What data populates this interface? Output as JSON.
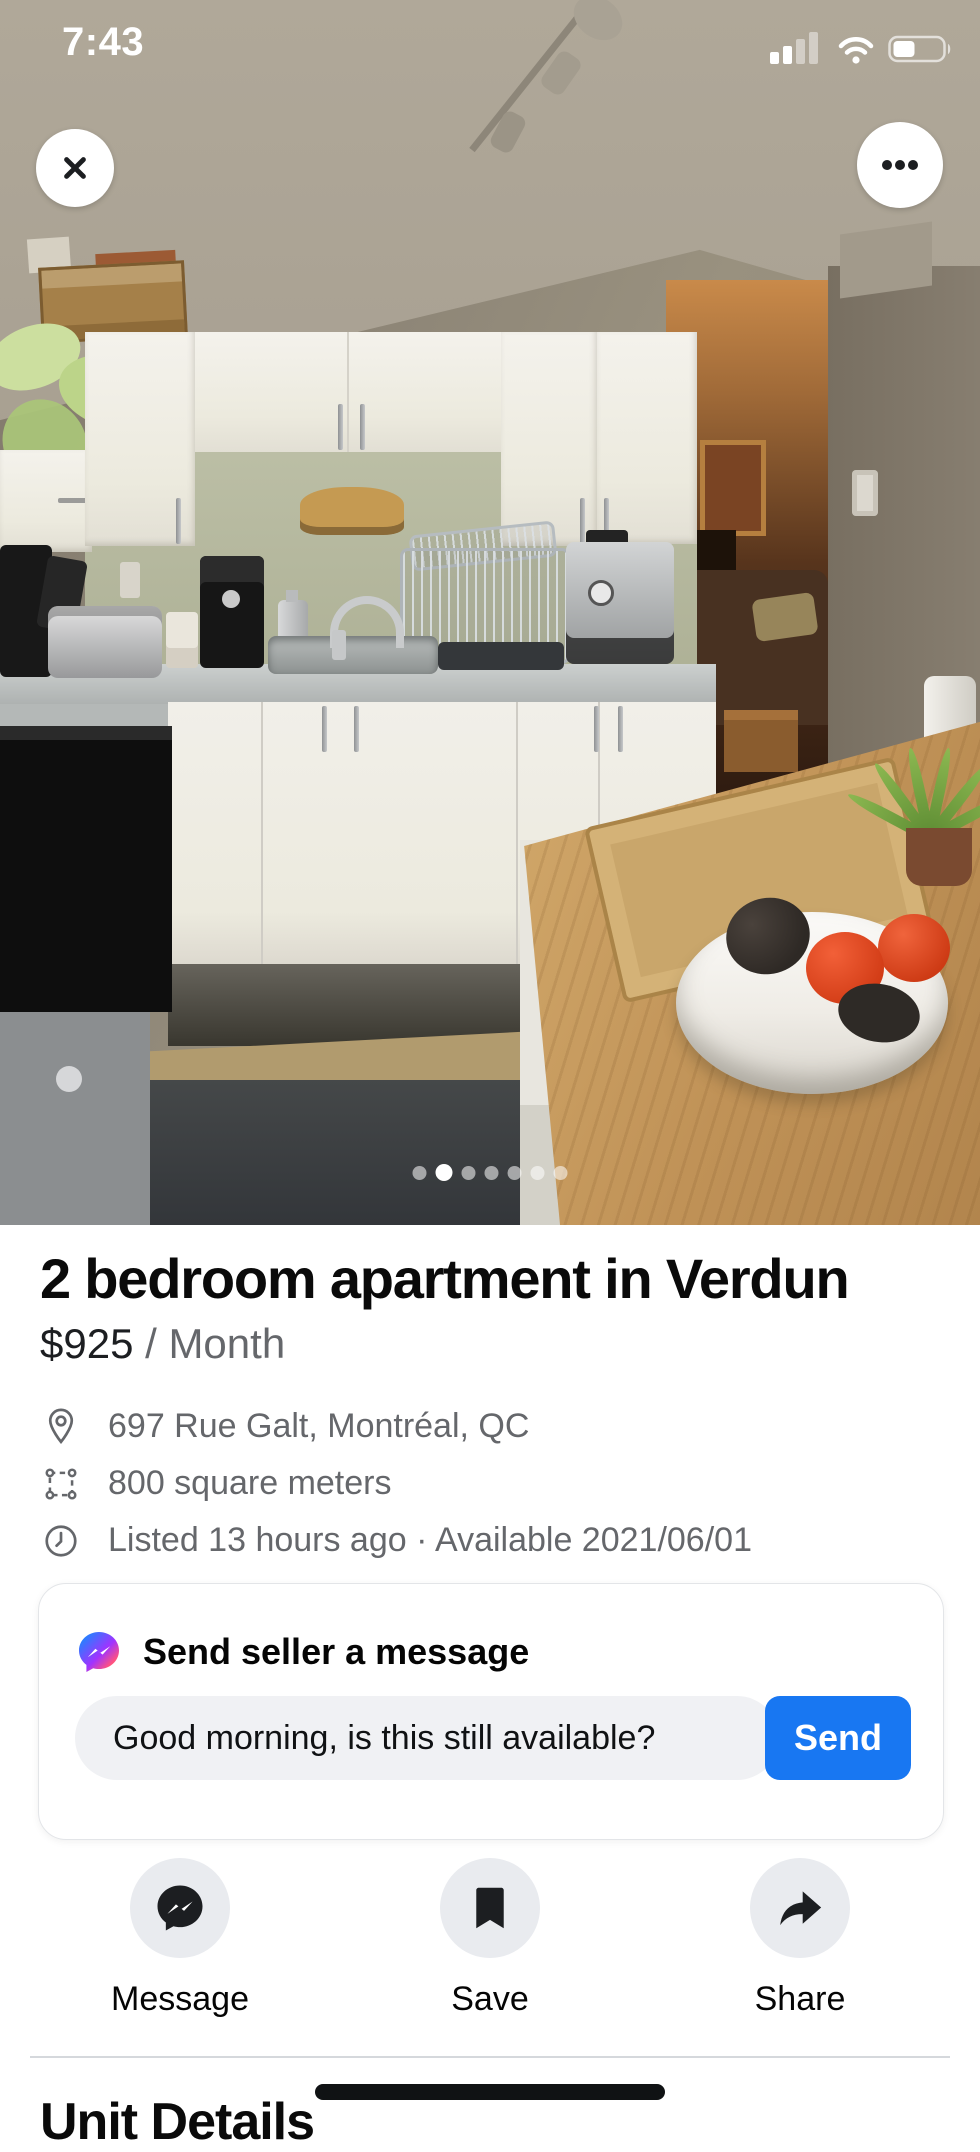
{
  "status_bar": {
    "time": "7:43"
  },
  "photo": {
    "description": "Kitchen photo of the apartment",
    "dots_total": 7,
    "active_dot": 2
  },
  "listing": {
    "title": "2 bedroom apartment in Verdun",
    "price": "$925",
    "price_unit": "/ Month",
    "details": [
      {
        "icon": "location-pin-icon",
        "text": "697 Rue Galt, Montréal, QC"
      },
      {
        "icon": "area-dimensions-icon",
        "text": "800 square meters"
      },
      {
        "icon": "clock-icon",
        "text": "Listed 13 hours ago · Available 2021/06/01"
      }
    ]
  },
  "message_card": {
    "icon": "messenger-icon",
    "title": "Send seller a message",
    "input_value": "Good morning, is this still available?",
    "send_label": "Send"
  },
  "action_bar": [
    {
      "icon": "messenger-icon",
      "label": "Message"
    },
    {
      "icon": "bookmark-icon",
      "label": "Save"
    },
    {
      "icon": "share-icon",
      "label": "Share"
    }
  ],
  "next_section": {
    "heading": "Unit Details"
  },
  "colors": {
    "accent_blue": "#1877F2",
    "muted_text": "#65676B",
    "input_bg": "#F0F1F4",
    "action_circle_bg": "#E9EBEF"
  }
}
